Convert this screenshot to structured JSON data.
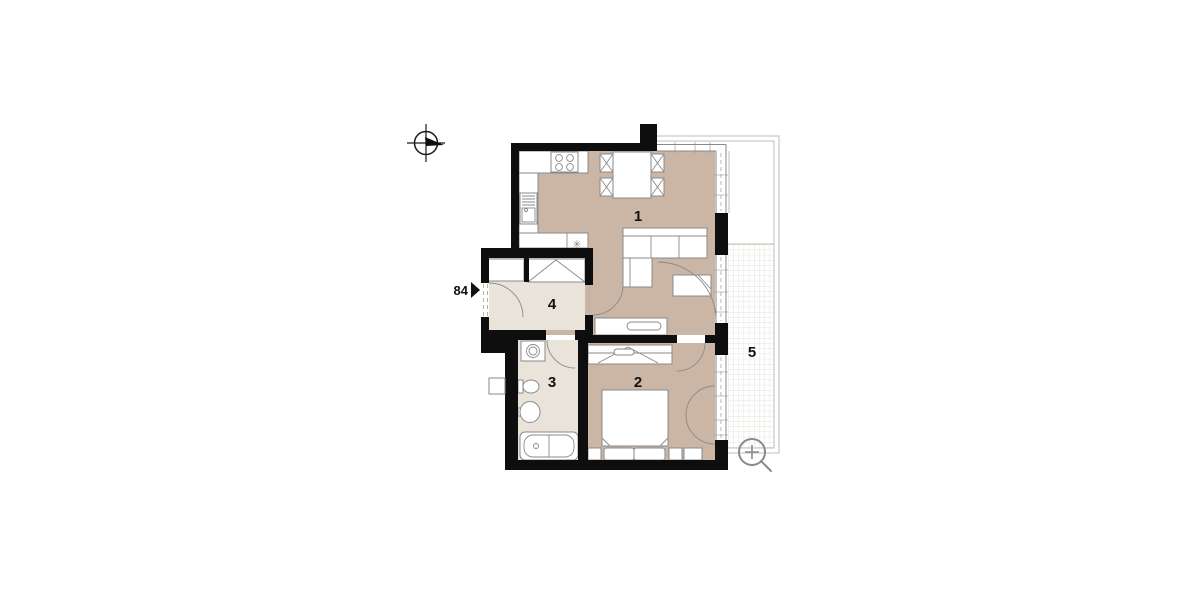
{
  "canvas": {
    "width": 1200,
    "height": 600,
    "background": "#ffffff"
  },
  "floor_plan": {
    "rooms": [
      {
        "number": "1"
      },
      {
        "number": "2"
      },
      {
        "number": "3"
      },
      {
        "number": "4"
      },
      {
        "number": "5"
      }
    ],
    "entry_marker": {
      "label": "84",
      "symbol": "right-filled-triangle"
    },
    "kitchen_symbol": "✳"
  },
  "icons": {
    "compass": "compass-rose-icon",
    "zoom": "zoom-in-magnifier-icon"
  },
  "colors": {
    "wall": "#0e0e0e",
    "room_warm": "#cbb6a5",
    "room_light": "#e9e3d9",
    "furniture_line": "#8a8a8a",
    "outline_light": "#c2beb6",
    "grid": "#e7e3dc",
    "icon": "#8a8a8a",
    "text": "#111111"
  }
}
